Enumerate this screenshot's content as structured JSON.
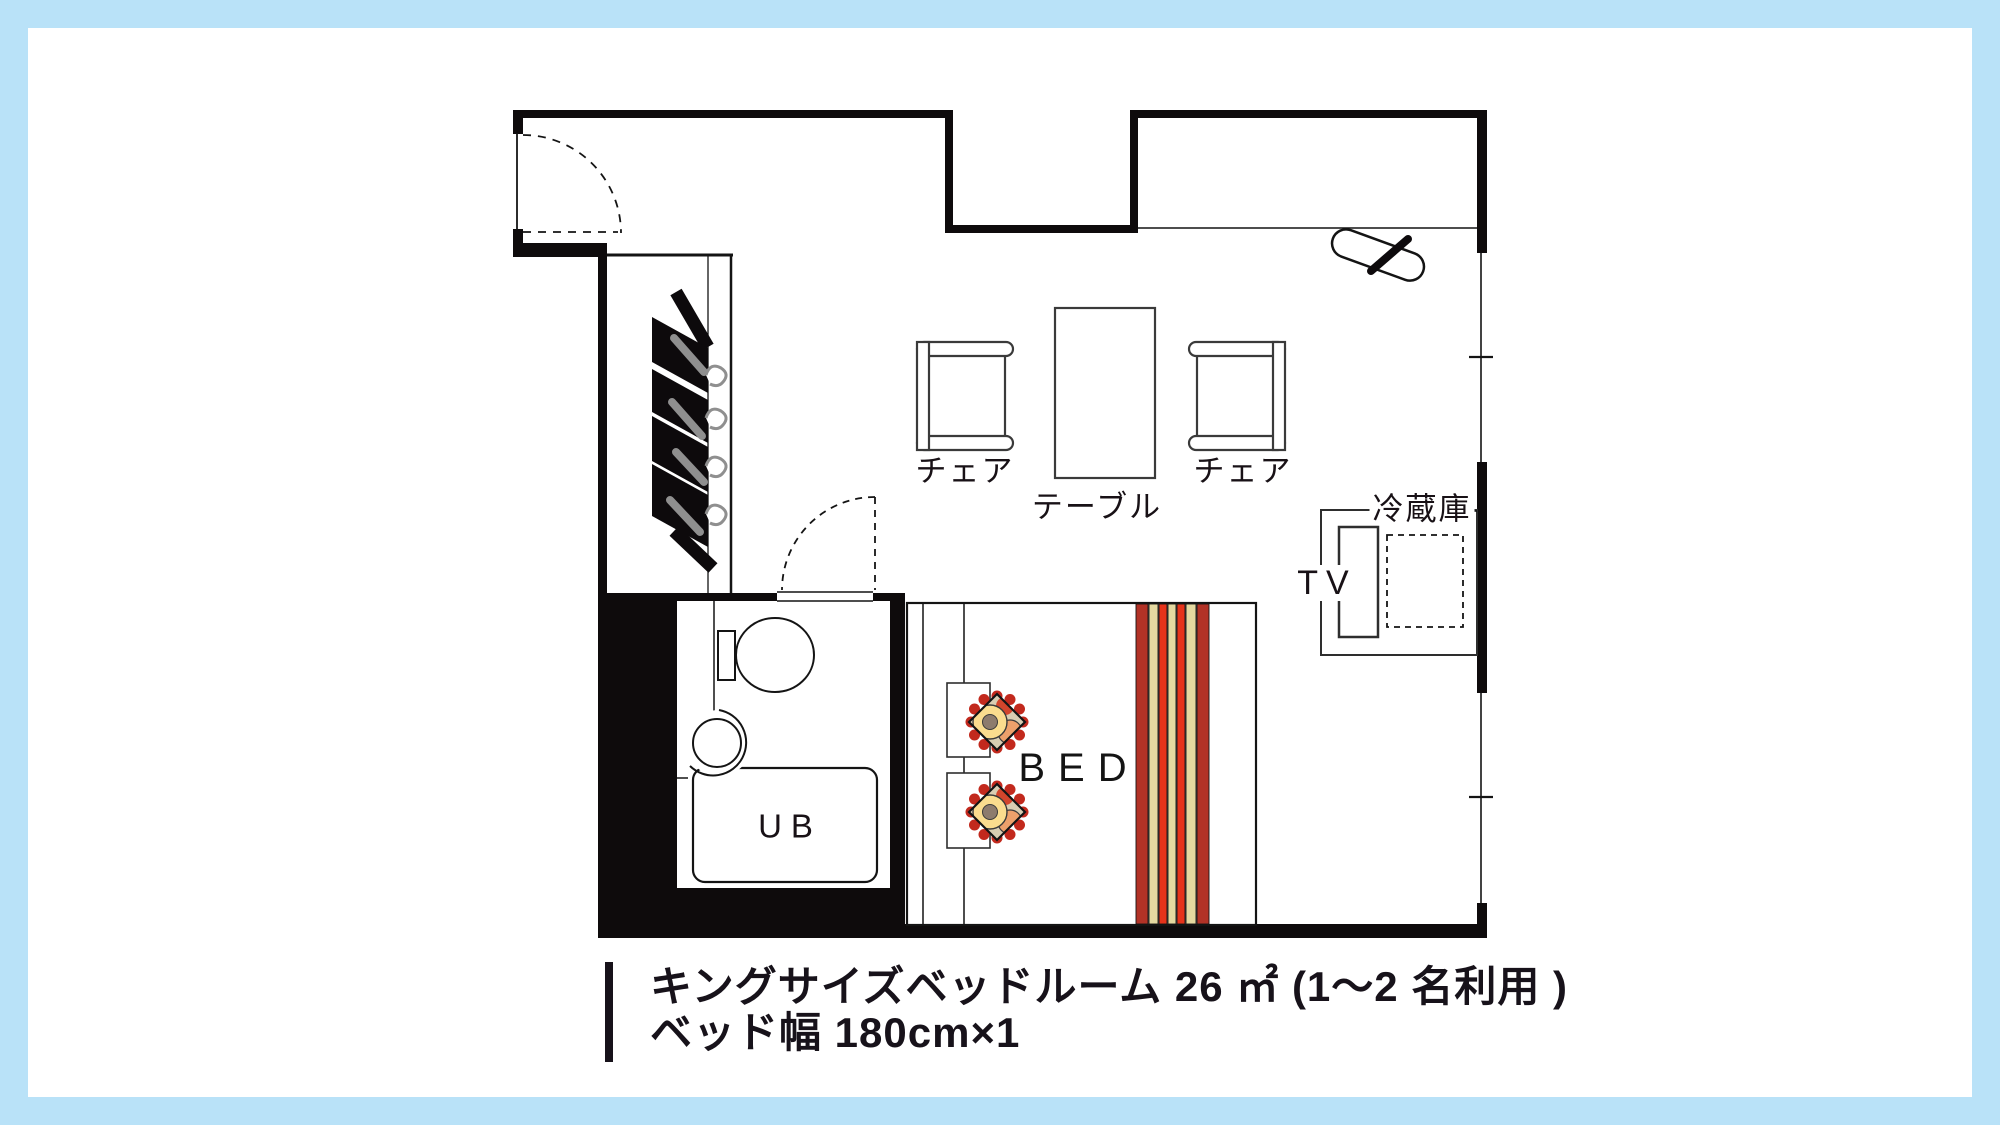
{
  "page": {
    "background": "#b9e2f8",
    "card_background": "#ffffff"
  },
  "palette": {
    "wall": "#0e0b0c",
    "line": "#141414",
    "stripe_dark_red": "#b23226",
    "stripe_red": "#e6331a",
    "stripe_cream": "#e5d9a0",
    "ornament_base": "#d9cdb2",
    "ornament_scallop": "#c2291d",
    "ornament_bun": "#fadc8e",
    "ornament_core": "#8d7b6d",
    "ornament_orange": "#eda06b",
    "ornament_accent": "#d2452c",
    "hanger_gray": "#8f8f8f",
    "garment_black": "#0d0a0c"
  },
  "plan": {
    "labels": {
      "chair_left": "チェア",
      "table": "テーブル",
      "chair_right": "チェア",
      "fridge": "冷蔵庫",
      "tv": "TV",
      "bathtub": "UB",
      "bed": "BED"
    },
    "caption": {
      "line1": "キングサイズベッドルーム 26 ㎡ (1〜2 名利用 )",
      "line2": "ベッド幅 180cm×1"
    }
  }
}
